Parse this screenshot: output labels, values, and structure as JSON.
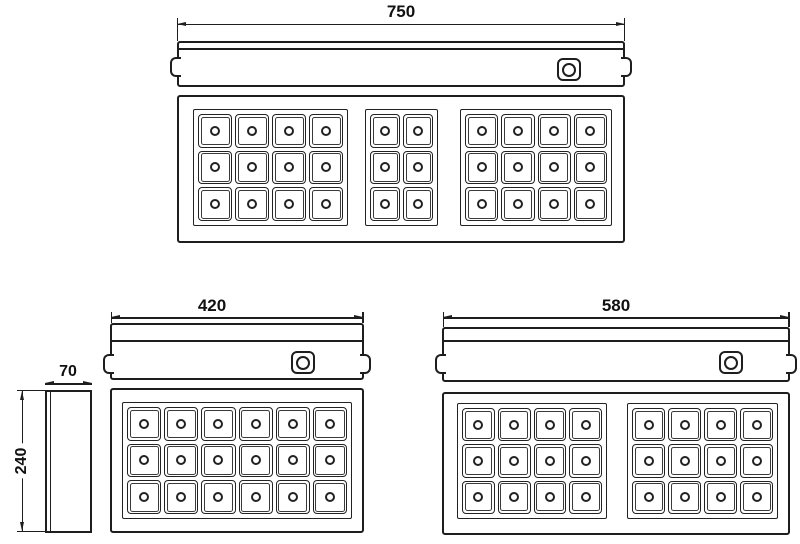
{
  "drawing": {
    "background": "#ffffff",
    "line_color": "#1e1e1e",
    "units": [
      {
        "name": "chuck-750",
        "dimension": "750",
        "pole_groups": [
          {
            "cols": 4,
            "rows": 3
          },
          {
            "cols": 2,
            "rows": 3
          },
          {
            "cols": 4,
            "rows": 3
          }
        ]
      },
      {
        "name": "chuck-420",
        "dimension": "420",
        "pole_groups": [
          {
            "cols": 6,
            "rows": 3
          }
        ]
      },
      {
        "name": "chuck-580",
        "dimension": "580",
        "pole_groups": [
          {
            "cols": 4,
            "rows": 3
          },
          {
            "cols": 4,
            "rows": 3
          }
        ]
      }
    ],
    "side_view": {
      "width_dimension": "70",
      "height_dimension": "240"
    }
  }
}
